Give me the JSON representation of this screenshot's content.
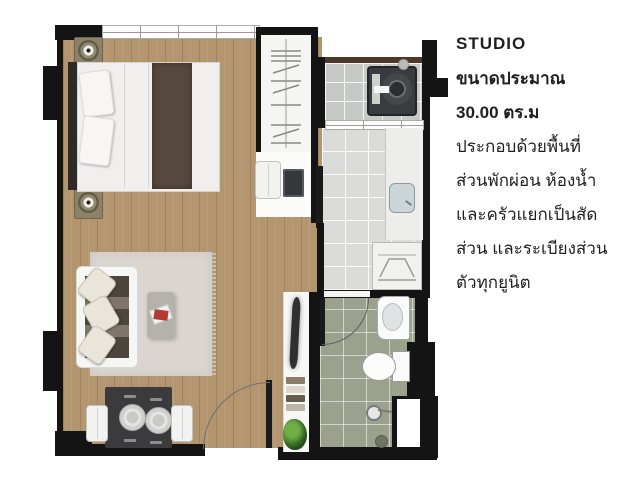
{
  "info": {
    "title": "STUDIO",
    "size_label": "ขนาดประมาณ",
    "size_value": "30.00 ตร.ม",
    "description_lines": [
      "ประกอบด้วยพื้นที่",
      "ส่วนพักผ่อน ห้องน้ำ",
      "และครัวแยกเป็นสัด",
      "ส่วน และระเบียงส่วน",
      "ตัวทุกยูนิต"
    ]
  },
  "floorplan": {
    "features": [
      "double-bed",
      "nightstand-lamp-top",
      "nightstand-lamp-bottom",
      "wardrobe",
      "desk-with-computer",
      "desk-chair",
      "sofa",
      "coffee-table",
      "rug",
      "dining-table-for-two",
      "entrance-door",
      "bathroom-door",
      "balcony-washing-machine",
      "kitchen-sink",
      "stove-counter",
      "bathroom-sink",
      "toilet",
      "shower",
      "floor-drain",
      "console-shelf",
      "towels",
      "plant",
      "service-shaft",
      "windows"
    ]
  },
  "colors": {
    "wall": "#141414",
    "wood": "#b3956f",
    "balcony_tile": "#c7c9c7",
    "kitchen_tile": "#dadbd8",
    "bath_tile": "#9ba18d",
    "railing": "#4b3a2a",
    "rug": "#dad6cf",
    "text": "#1f1f1f"
  }
}
